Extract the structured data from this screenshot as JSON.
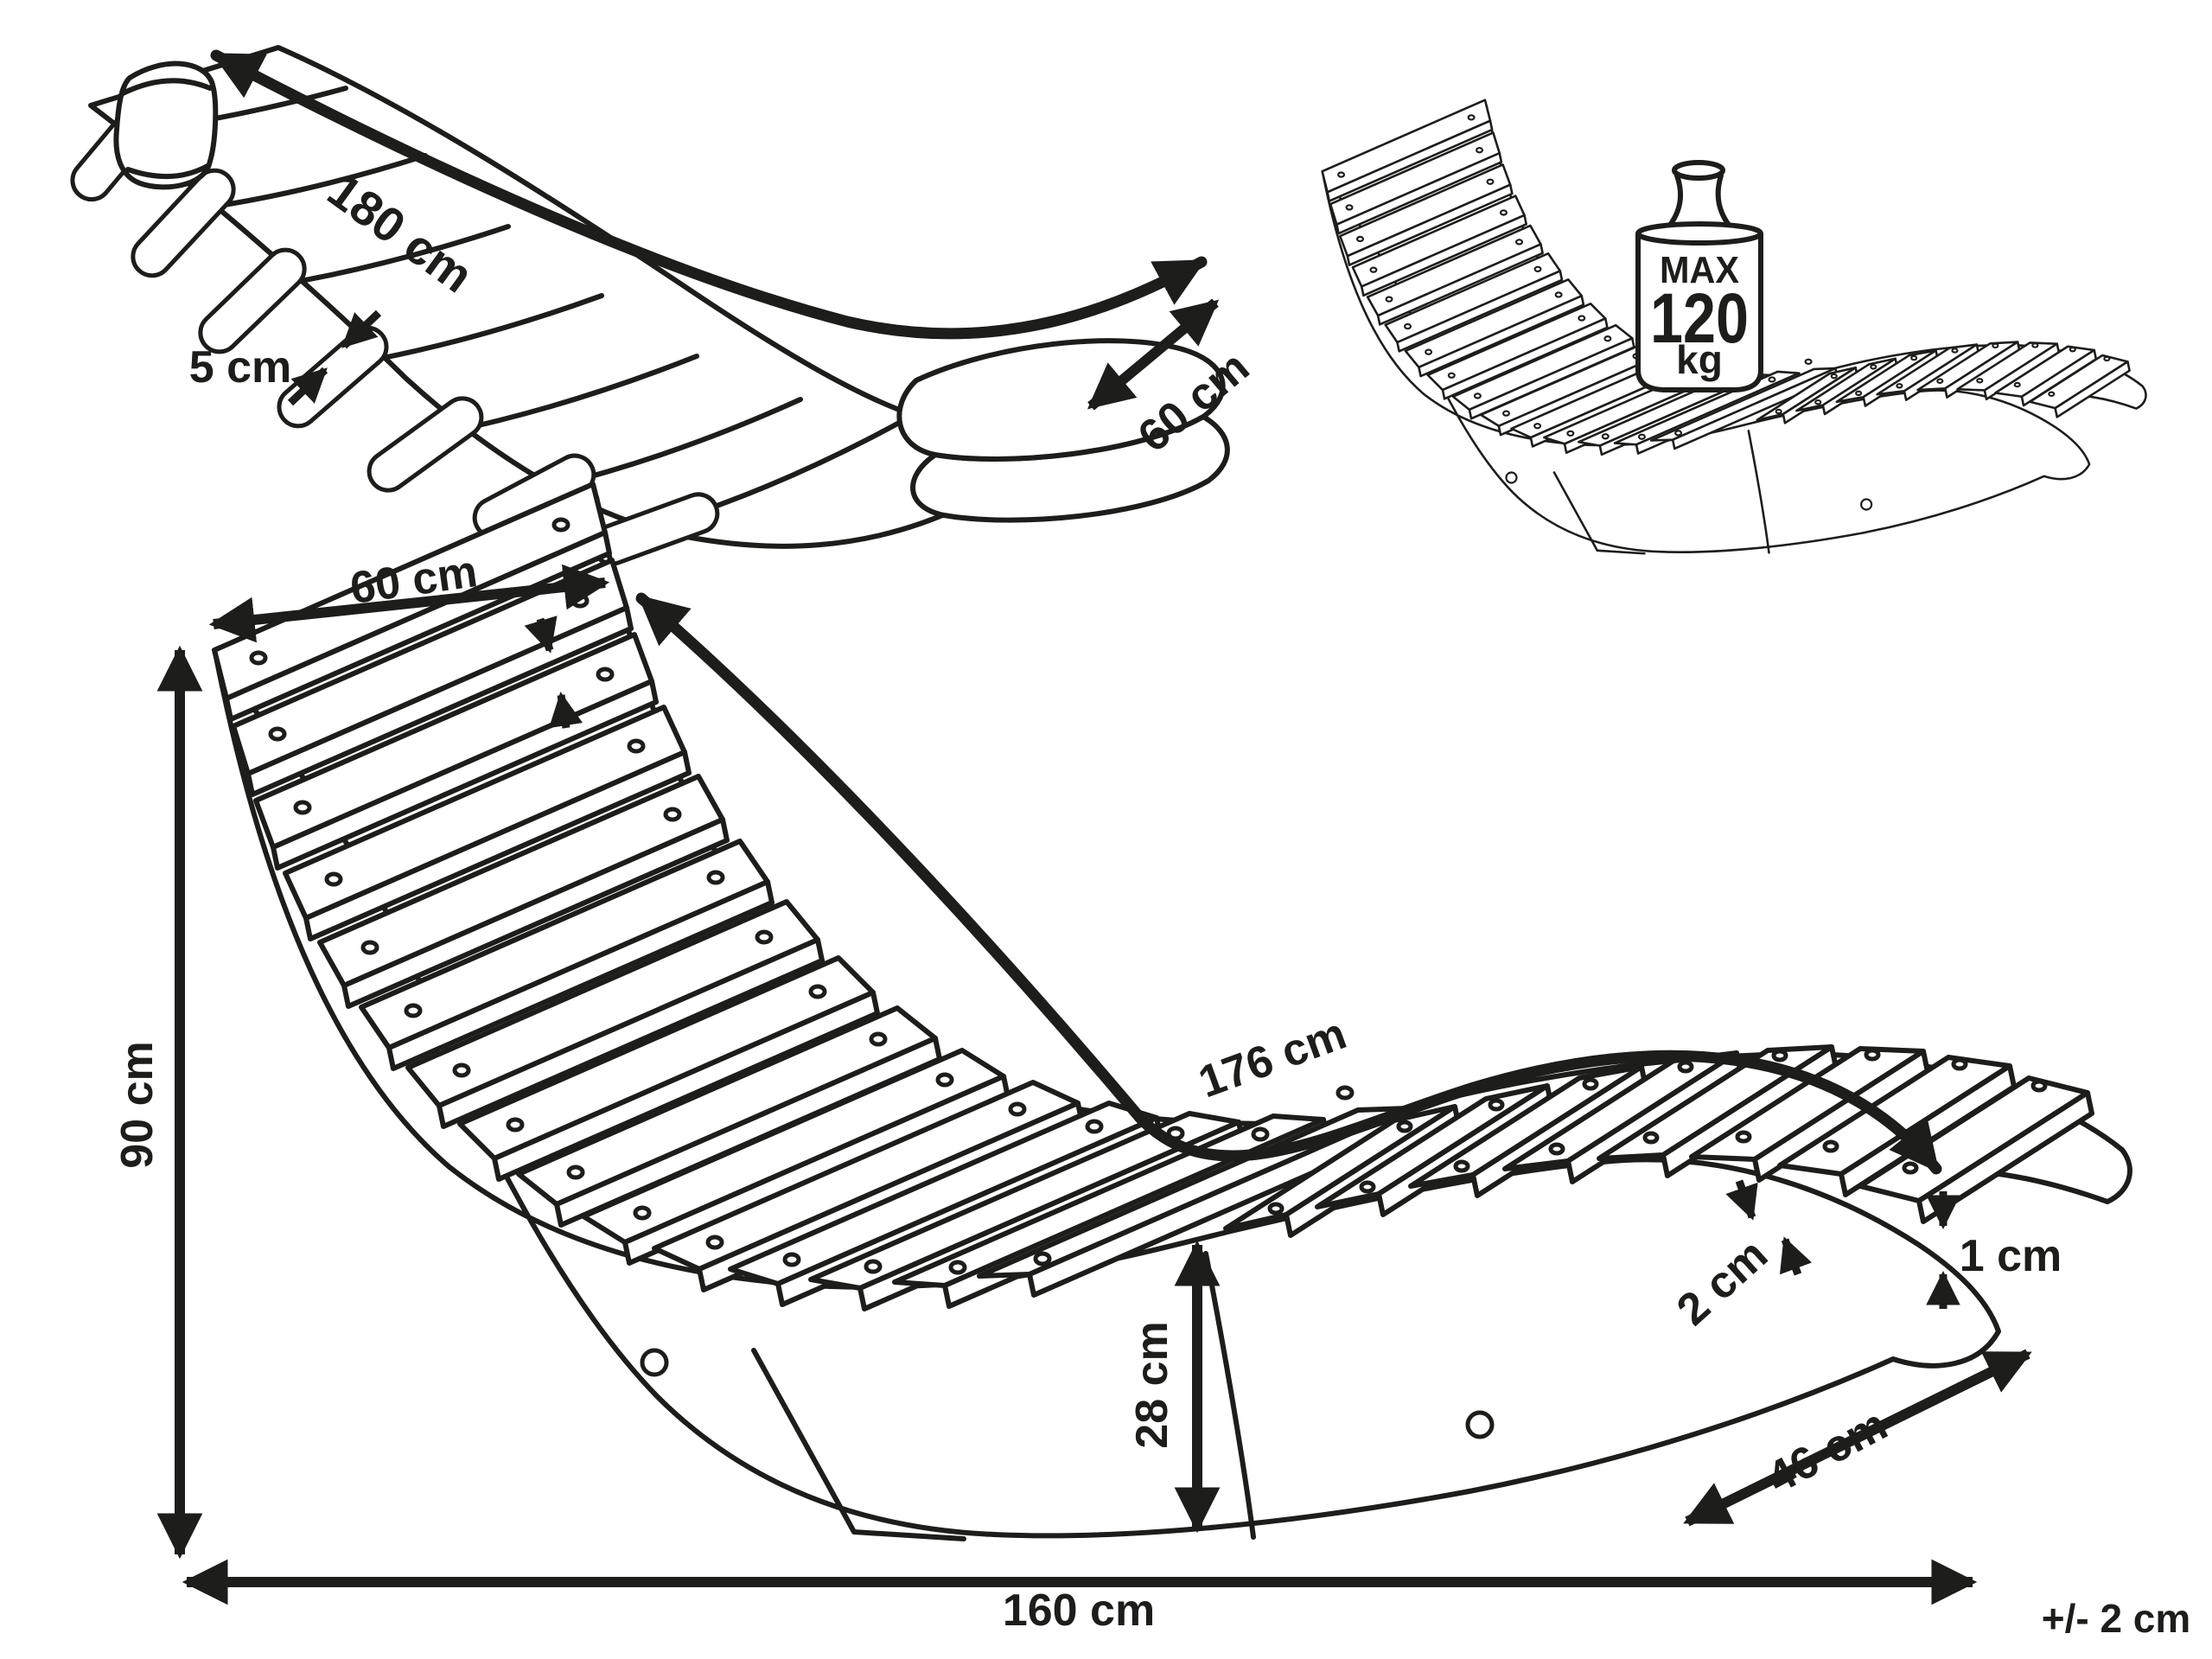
{
  "colors": {
    "ink": "#1d1d1b",
    "background": "#ffffff"
  },
  "figures": {
    "cushion": {
      "description": "padded lounger cushion view",
      "length": "180 cm",
      "thickness": "5 cm",
      "width": "60 cm"
    },
    "capacity": {
      "description": "maximum load view",
      "max_label": "MAX",
      "max_value": "120",
      "max_unit": "kg"
    },
    "dimensions": {
      "description": "slatted rocking lounger dimension view",
      "slat_top_width": "60 cm",
      "height": "90 cm",
      "lying_surface": "176 cm",
      "seat_height": "28 cm",
      "slat_gap": "2 cm",
      "slat_thickness": "1 cm",
      "foot_width": "46 cm",
      "total_length": "160 cm",
      "tolerance": "+/- 2 cm"
    }
  }
}
